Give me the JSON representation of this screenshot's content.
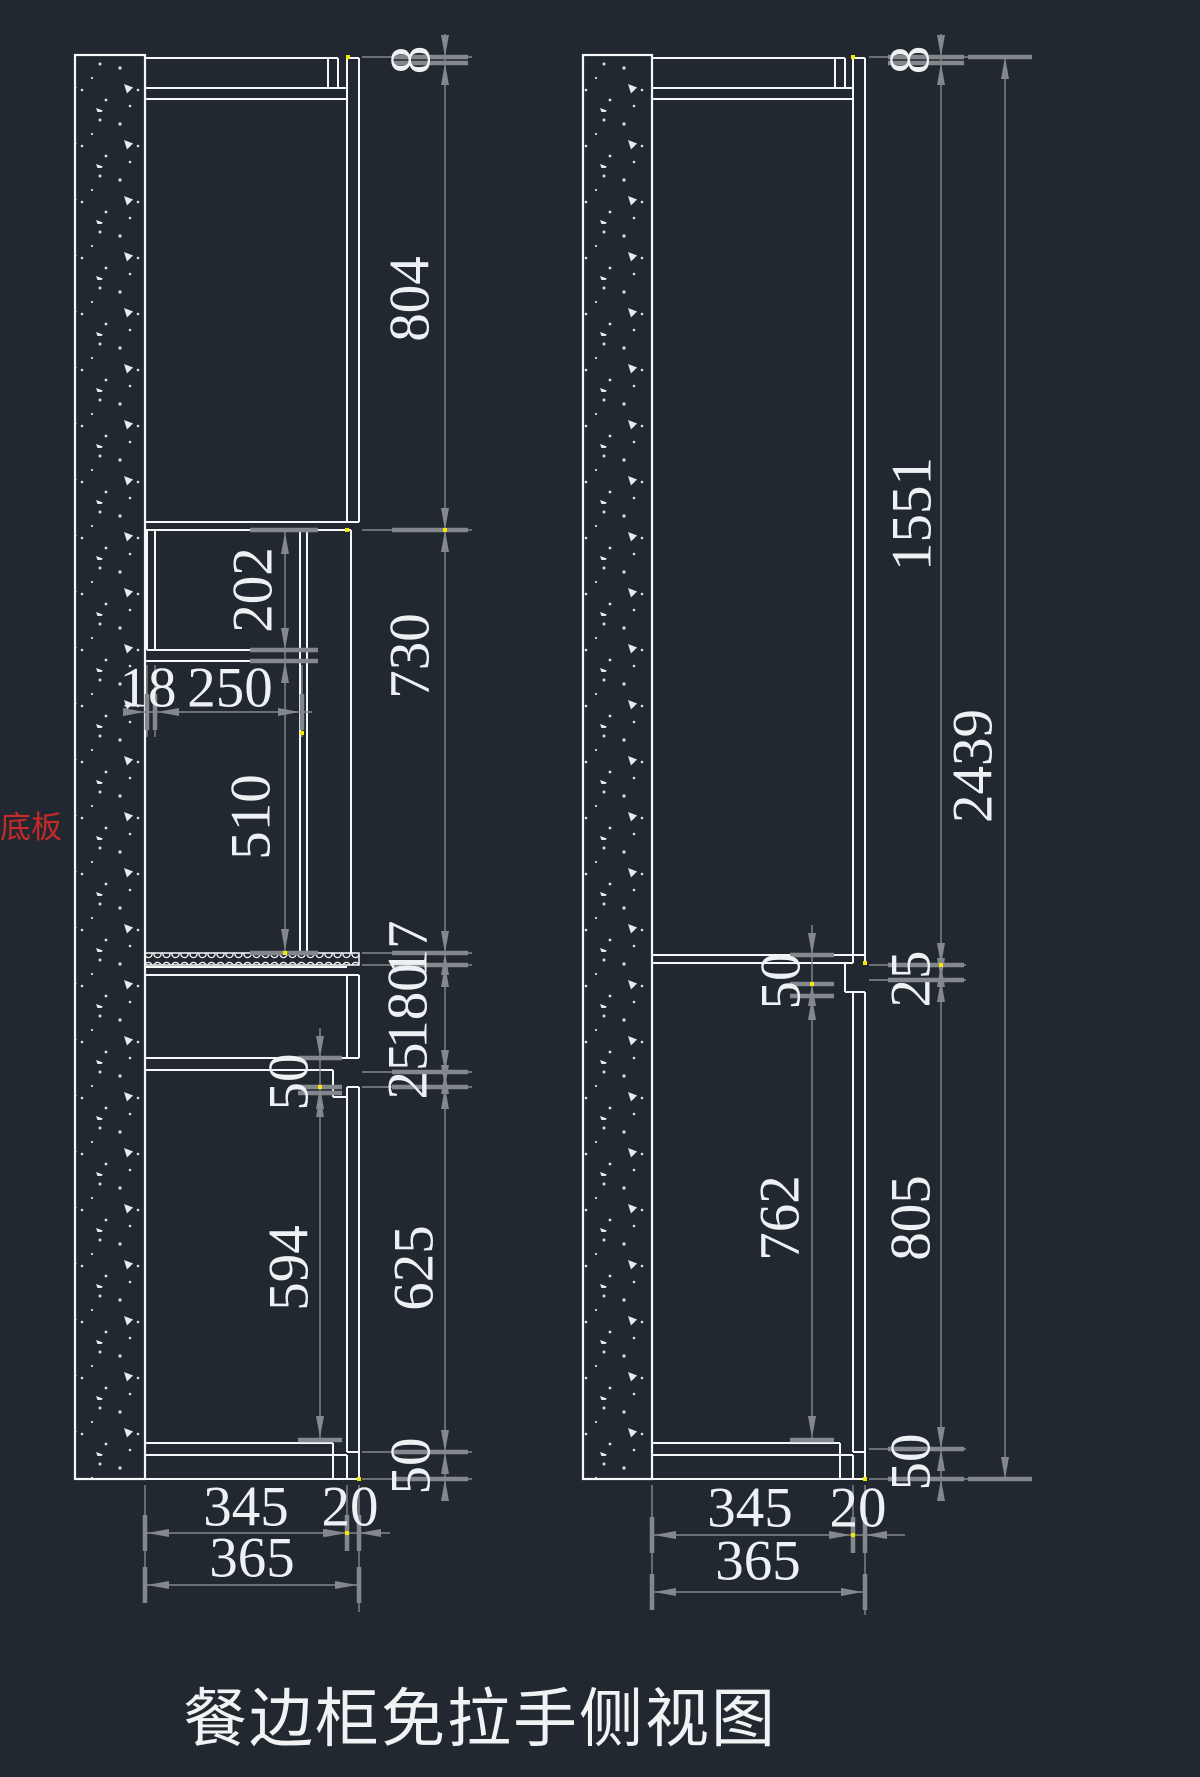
{
  "title": "餐边柜免拉手侧视图",
  "labels": {
    "bottom_panel": "底板"
  },
  "colors": {
    "background": "#212830",
    "outline": "#f5f7f8",
    "dimension": "#84888c",
    "dim_text": "#eef1f4",
    "annotation_red": "#c62a2a",
    "endpoint_yellow": "#f5e900"
  },
  "left_view": {
    "name": "cabinet-side-view-with-open-niche",
    "chain_dims": [
      "8",
      "804",
      "730",
      "17",
      "180",
      "25",
      "625",
      "50"
    ],
    "niche": {
      "height": "202",
      "wall_thickness": "18",
      "depth": "250"
    },
    "open_height": "510",
    "drawer_gap": "50",
    "door_height": "594",
    "depth": {
      "body": "345",
      "door": "20",
      "total": "365"
    }
  },
  "right_view": {
    "name": "cabinet-side-view-full-door",
    "chain_dims": [
      "8",
      "1551",
      "25",
      "805",
      "50"
    ],
    "overall_height": "2439",
    "shelf_gap": "50",
    "door_height": "762",
    "depth": {
      "body": "345",
      "door": "20",
      "total": "365"
    }
  }
}
